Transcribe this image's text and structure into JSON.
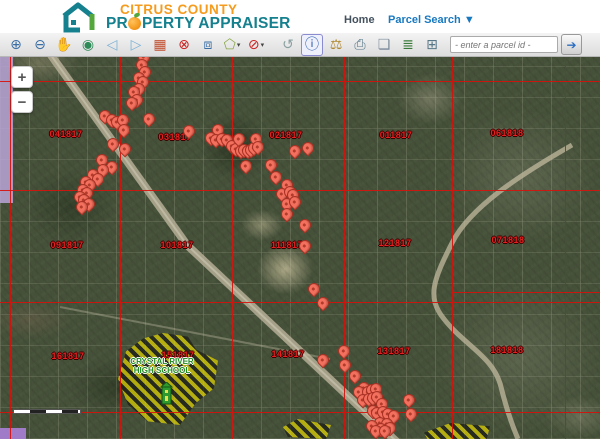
{
  "header": {
    "logo": {
      "line1": "CITRUS COUNTY",
      "line2_prefix": "PR",
      "line2_suffix": "PERTY APPRAISER"
    },
    "nav": {
      "home": "Home",
      "parcel_search": "Parcel Search ▼"
    }
  },
  "toolbar": {
    "buttons": [
      {
        "name": "zoom-in",
        "icon": "⊕",
        "color": "#3b6ea5"
      },
      {
        "name": "zoom-out",
        "icon": "⊖",
        "color": "#3b6ea5"
      },
      {
        "name": "pan",
        "icon": "✋",
        "color": "#4a86c8"
      },
      {
        "name": "full-extent-globe",
        "icon": "◉",
        "color": "#2e8b57"
      },
      {
        "name": "previous-extent",
        "icon": "◁",
        "color": "#7ab0d4"
      },
      {
        "name": "next-extent",
        "icon": "▷",
        "color": "#7ab0d4"
      },
      {
        "name": "initial-map",
        "icon": "▦",
        "color": "#c05030"
      },
      {
        "name": "clear-graphics",
        "icon": "⊗",
        "color": "#cc2222"
      },
      {
        "name": "zoom-to-rectangle",
        "icon": "⧈",
        "color": "#3b6ea5"
      },
      {
        "name": "select-by-polygon",
        "icon": "⬠",
        "color": "#8aa84a",
        "caret": true
      },
      {
        "name": "clear-selection",
        "icon": "⊘",
        "color": "#cc2222",
        "caret": true
      },
      {
        "name": "undo-extent",
        "icon": "↺",
        "color": "#8aa0a0",
        "gap": true
      },
      {
        "name": "identify-info",
        "icon": "ⓘ",
        "color": "#2255aa",
        "selected": true
      },
      {
        "name": "measure",
        "icon": "⚖",
        "color": "#b08830"
      },
      {
        "name": "print",
        "icon": "⎙",
        "color": "#557788"
      },
      {
        "name": "full-screen-extent",
        "icon": "❏",
        "color": "#7a8a9a"
      },
      {
        "name": "layers",
        "icon": "≣",
        "color": "#3a7a3a"
      },
      {
        "name": "overview-map",
        "icon": "⊞",
        "color": "#557788"
      }
    ],
    "search": {
      "placeholder": "- enter a parcel id -",
      "go_icon": "➔"
    }
  },
  "map": {
    "zoom_controls": {
      "zoom_in": "+",
      "zoom_out": "−"
    },
    "grid": {
      "color": "#d70f0a",
      "vertical_x": [
        10,
        120,
        232,
        344,
        452,
        565
      ],
      "horizontal_y": [
        24,
        133,
        245,
        355
      ],
      "segments": [
        {
          "y": 235,
          "x1": 452,
          "x2": 600
        }
      ]
    },
    "section_labels": [
      {
        "text": "041817",
        "x": 66,
        "y": 77
      },
      {
        "text": "031817",
        "x": 175,
        "y": 80
      },
      {
        "text": "021817",
        "x": 286,
        "y": 78
      },
      {
        "text": "011817",
        "x": 396,
        "y": 78
      },
      {
        "text": "061818",
        "x": 507,
        "y": 76
      },
      {
        "text": "091817",
        "x": 67,
        "y": 188
      },
      {
        "text": "101817",
        "x": 177,
        "y": 188
      },
      {
        "text": "111817",
        "x": 287,
        "y": 188
      },
      {
        "text": "121817",
        "x": 395,
        "y": 186
      },
      {
        "text": "071818",
        "x": 508,
        "y": 183
      },
      {
        "text": "161817",
        "x": 68,
        "y": 299
      },
      {
        "text": "151817",
        "x": 178,
        "y": 298
      },
      {
        "text": "141817",
        "x": 288,
        "y": 297
      },
      {
        "text": "131817",
        "x": 394,
        "y": 294
      },
      {
        "text": "181818",
        "x": 507,
        "y": 293
      }
    ],
    "pins": [
      [
        147,
        3
      ],
      [
        144,
        8
      ],
      [
        142,
        16
      ],
      [
        145,
        23
      ],
      [
        139,
        29
      ],
      [
        143,
        33
      ],
      [
        139,
        40
      ],
      [
        134,
        43
      ],
      [
        137,
        51
      ],
      [
        132,
        54
      ],
      [
        105,
        67
      ],
      [
        112,
        71
      ],
      [
        117,
        73
      ],
      [
        123,
        71
      ],
      [
        124,
        81
      ],
      [
        149,
        70
      ],
      [
        113,
        95
      ],
      [
        125,
        100
      ],
      [
        102,
        111
      ],
      [
        112,
        118
      ],
      [
        103,
        121
      ],
      [
        93,
        126
      ],
      [
        98,
        130
      ],
      [
        86,
        133
      ],
      [
        90,
        136
      ],
      [
        83,
        141
      ],
      [
        87,
        144
      ],
      [
        80,
        148
      ],
      [
        84,
        151
      ],
      [
        89,
        155
      ],
      [
        82,
        158
      ],
      [
        189,
        82
      ],
      [
        218,
        81
      ],
      [
        211,
        89
      ],
      [
        216,
        91
      ],
      [
        222,
        90
      ],
      [
        227,
        91
      ],
      [
        232,
        97
      ],
      [
        236,
        100
      ],
      [
        239,
        90
      ],
      [
        241,
        102
      ],
      [
        244,
        101
      ],
      [
        248,
        102
      ],
      [
        251,
        101
      ],
      [
        254,
        99
      ],
      [
        256,
        90
      ],
      [
        258,
        98
      ],
      [
        246,
        117
      ],
      [
        271,
        116
      ],
      [
        295,
        102
      ],
      [
        308,
        99
      ],
      [
        276,
        128
      ],
      [
        287,
        136
      ],
      [
        282,
        145
      ],
      [
        290,
        143
      ],
      [
        293,
        146
      ],
      [
        287,
        155
      ],
      [
        295,
        153
      ],
      [
        287,
        165
      ],
      [
        305,
        176
      ],
      [
        305,
        197
      ],
      [
        314,
        240
      ],
      [
        323,
        254
      ],
      [
        323,
        311
      ],
      [
        344,
        302
      ],
      [
        345,
        316
      ],
      [
        355,
        327
      ],
      [
        364,
        339
      ],
      [
        359,
        343
      ],
      [
        368,
        343
      ],
      [
        372,
        341
      ],
      [
        376,
        340
      ],
      [
        363,
        351
      ],
      [
        369,
        350
      ],
      [
        373,
        349
      ],
      [
        377,
        348
      ],
      [
        382,
        355
      ],
      [
        373,
        362
      ],
      [
        377,
        364
      ],
      [
        383,
        363
      ],
      [
        388,
        365
      ],
      [
        394,
        367
      ],
      [
        409,
        351
      ],
      [
        411,
        365
      ],
      [
        380,
        374
      ],
      [
        387,
        375
      ],
      [
        372,
        377
      ],
      [
        381,
        380
      ],
      [
        390,
        379
      ],
      [
        376,
        382
      ],
      [
        385,
        382
      ]
    ],
    "school": {
      "line1": "CRYSTAL RIVER",
      "line2": "HIGH SCHOOL"
    },
    "colors": {
      "pin_fill": "#f3705e",
      "pin_border": "#a93123",
      "grid_red": "#d70f0a",
      "label_red": "#e81f1f",
      "school_green": "#1e8a1e",
      "hatch_yellow": "#e8da00",
      "brand_orange": "#f59b1e",
      "brand_teal": "#15808e",
      "link_blue": "#1879c0"
    }
  }
}
